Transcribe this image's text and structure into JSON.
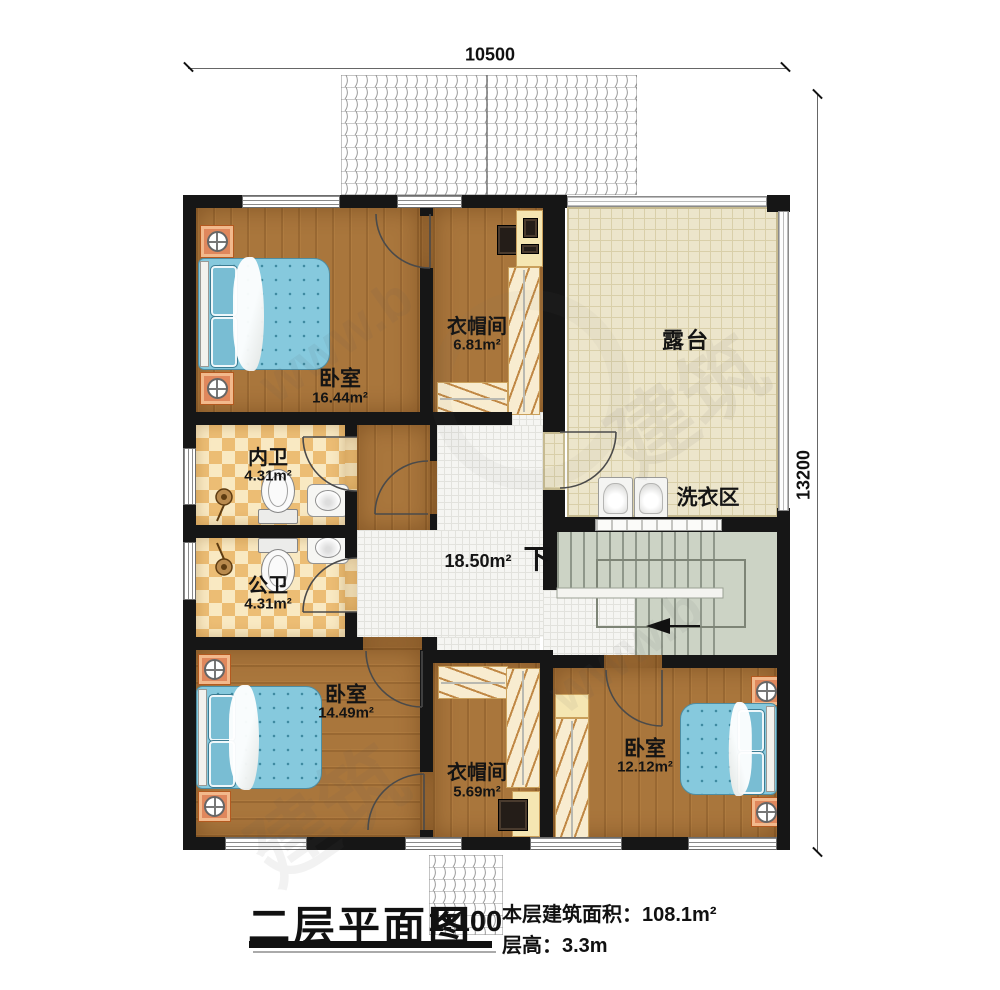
{
  "plan": {
    "dimensions": {
      "width_mm": "10500",
      "height_mm": "13200"
    },
    "rooms": {
      "bedroom_top_left": {
        "name": "卧室",
        "area": "16.44m²"
      },
      "closet_top": {
        "name": "衣帽间",
        "area": "6.81m²"
      },
      "terrace": {
        "name": "露台"
      },
      "bath_inner": {
        "name": "内卫",
        "area": "4.31m²"
      },
      "bath_public": {
        "name": "公卫",
        "area": "4.31m²"
      },
      "laundry": {
        "name": "洗衣区"
      },
      "hall": {
        "area": "18.50m²",
        "stairs_down": "下"
      },
      "bedroom_bottom_left": {
        "name": "卧室",
        "area": "14.49m²"
      },
      "closet_bottom": {
        "name": "衣帽间",
        "area": "5.69m²"
      },
      "bedroom_bottom_right": {
        "name": "卧室",
        "area": "12.12m²"
      }
    }
  },
  "title_block": {
    "title": "二层平面图",
    "scale": "1:100",
    "floor_area_label": "本层建筑面积：",
    "floor_area_value": "108.1m²",
    "floor_height_label": "层高：",
    "floor_height_value": "3.3m"
  },
  "watermark": {
    "url_text": "www.b",
    "brand_text": "建筑"
  },
  "colors": {
    "wall": "#161616",
    "wood_floor": "#a9763c",
    "bathroom_tile": "#ecbd74",
    "terrace_tile": "#ece5cb",
    "hall_tile": "#f5f5f2",
    "stairs": "#ccd3c5",
    "bed": "#86c9dd",
    "nightstand": "#e0875c",
    "closet_rack": "#f8ecd0"
  }
}
